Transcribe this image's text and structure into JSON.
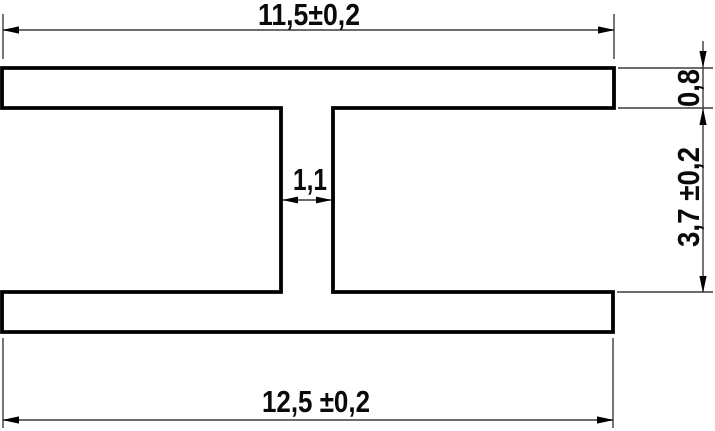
{
  "drawing": {
    "title": "H-profile cross-section with dimensions",
    "dimensions": {
      "top_width": "11,5±0,2",
      "flange_thickness": "0,8",
      "side_height": "3,7 ±0,2",
      "web_thickness": "1,1",
      "bottom_width": "12,5 ±0,2"
    },
    "colors": {
      "object_line": "#000000",
      "dim_line": "#3c3c3c",
      "background": "#ffffff"
    }
  }
}
